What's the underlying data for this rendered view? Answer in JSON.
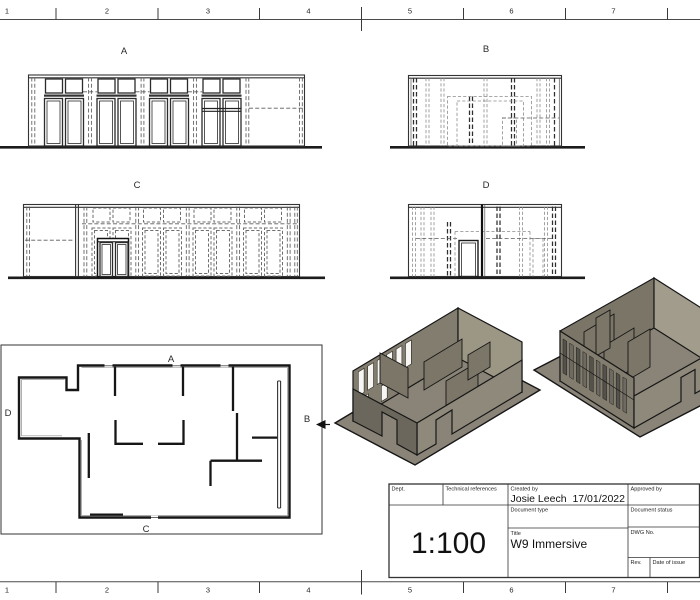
{
  "ruler": {
    "numbers": [
      "1",
      "2",
      "3",
      "4",
      "5",
      "6",
      "7"
    ]
  },
  "views": {
    "elevation_a": {
      "label": "A"
    },
    "elevation_b": {
      "label": "B"
    },
    "elevation_c": {
      "label": "C"
    },
    "elevation_d": {
      "label": "D"
    },
    "floor_plan": {
      "label_top": "A",
      "label_right": "B",
      "label_bottom": "C",
      "label_left": "D"
    }
  },
  "title_block": {
    "dept_label": "Dept.",
    "technical_references_label": "Technical references",
    "created_by_label": "Created by",
    "created_by_name": "Josie Leech",
    "created_by_date": "17/01/2022",
    "approved_by_label": "Approved by",
    "document_type_label": "Document type",
    "document_status_label": "Document status",
    "scale_value": "1:100",
    "title_label": "Title",
    "title_value": "W9 Immersive",
    "dwg_no_label": "DWG No.",
    "rev_label": "Rev.",
    "date_of_issue_label": "Date of issue"
  },
  "colors": {
    "model-tan": "#8a8478",
    "model-tan-light": "#a29c8c",
    "model-tan-mid": "#8f897b",
    "model-tan-dark": "#6b675d",
    "model-tan-deep": "#7b7567"
  }
}
